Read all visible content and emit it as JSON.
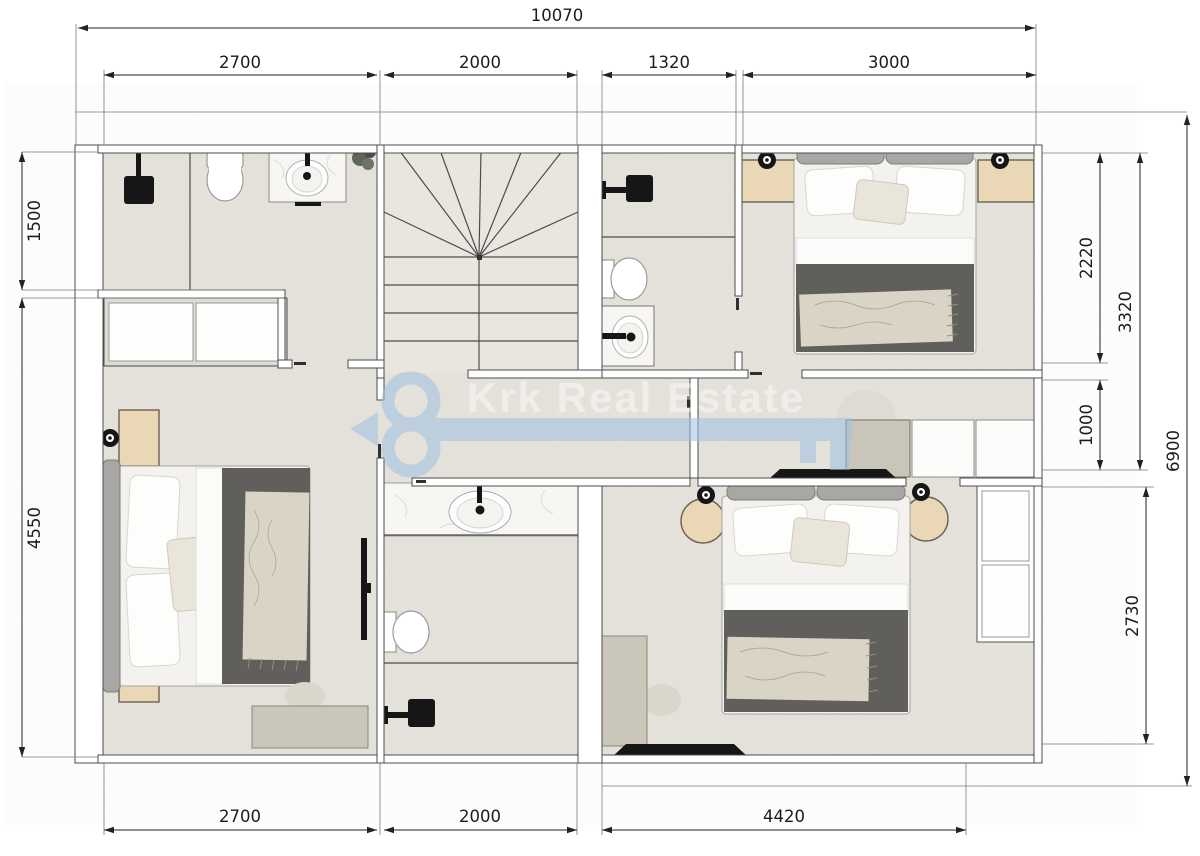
{
  "watermark": {
    "brand": "Krk Real Estate",
    "accent_color": "#9fc2e2",
    "text_color": "#ffffff"
  },
  "dimensions_mm": {
    "top_total": "10070",
    "top": [
      "2700",
      "2000",
      "1320",
      "3000"
    ],
    "bottom": [
      "2700",
      "2000",
      "4420"
    ],
    "left": [
      "1500",
      "4550"
    ],
    "right": [
      "2220",
      "3320",
      "1000",
      "2730",
      "6900"
    ]
  },
  "colors": {
    "floor": "#e6e3dc",
    "stairs_floor": "#e9e6e0",
    "wall_fill": "#ffffff",
    "wall_outline": "#4c4c4c",
    "dimension_line": "#222222",
    "furniture_wood": "#ead7b5",
    "duvet": "#605f5c",
    "linen": "#fdfdfc",
    "throw_blanket": "#d9d4c6",
    "cabinet": "#c9c5b8",
    "fixture_black": "#161616",
    "watermark_blue": "#9fc2e2"
  }
}
